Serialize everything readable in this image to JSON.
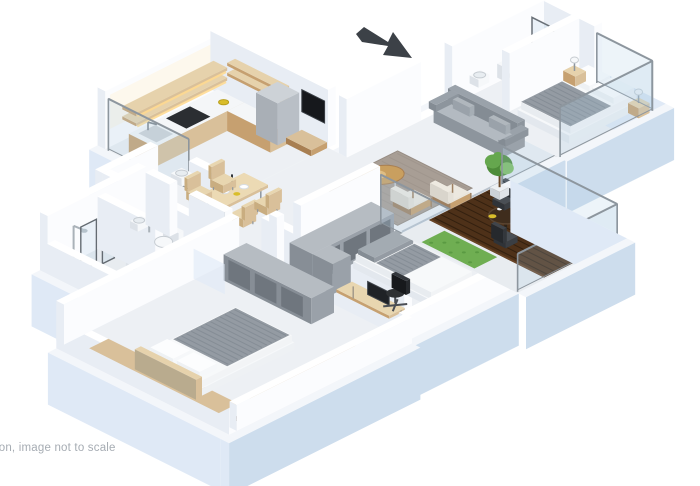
{
  "page": {
    "title": "3D isometric apartment floor plan render",
    "background": "#ffffff"
  },
  "disclaimer": {
    "text": "ation, image not to scale",
    "visible_fragment": "ion, image not to scale"
  },
  "icons": {
    "entrance_arrow": "arrow pointing down-right to entrance"
  },
  "palette": {
    "floor": "#edf0f4",
    "floor_dim": "#e8ecf0",
    "ledge": "#f3f6fa",
    "slab_side": "#dfe9f6",
    "slab_front": "#cddded",
    "wall_top": "#ffffff",
    "wall_shade": "#e8edf4",
    "wall_bright": "#fbfcfe",
    "wood_light": "#d9c09a",
    "wood_mid": "#c6a070",
    "wood_deep": "#a87f52",
    "deck_dark": "#4e3119",
    "deck_line": "#33200f",
    "sofa_gray": "#9aa2aa",
    "sofa_gray_dark": "#8d959d",
    "sofa_gray_light": "#b3bac1",
    "rug_taupe": "#a89e95",
    "blanket_gray": "#949ba3",
    "blanket_stripe": "#7f8890",
    "unit_gray": "#9aa1a9",
    "unit_gray_dark": "#878e96",
    "unit_inset": "#6f767e",
    "white_goods": "#f6f8fa",
    "fixture_shade": "#dde2e8",
    "plant_green_1": "#4e8c3a",
    "plant_green_2": "#65a74e",
    "plant_green_3": "#7cbd62",
    "grass_green": "#6fae52",
    "glass_fill": "rgba(173,203,227,0.22)",
    "frame_gray": "#8d969e",
    "steel": "#aab2b9",
    "tv_black": "#16181c",
    "chair_dark": "#3a3e43",
    "arrow_dark": "#3c4147",
    "text_gray": "#a6acb3",
    "glow_warm": "#ffd98e",
    "food_yellow": "#d9bd2b",
    "food_red": "#b83c2e"
  }
}
